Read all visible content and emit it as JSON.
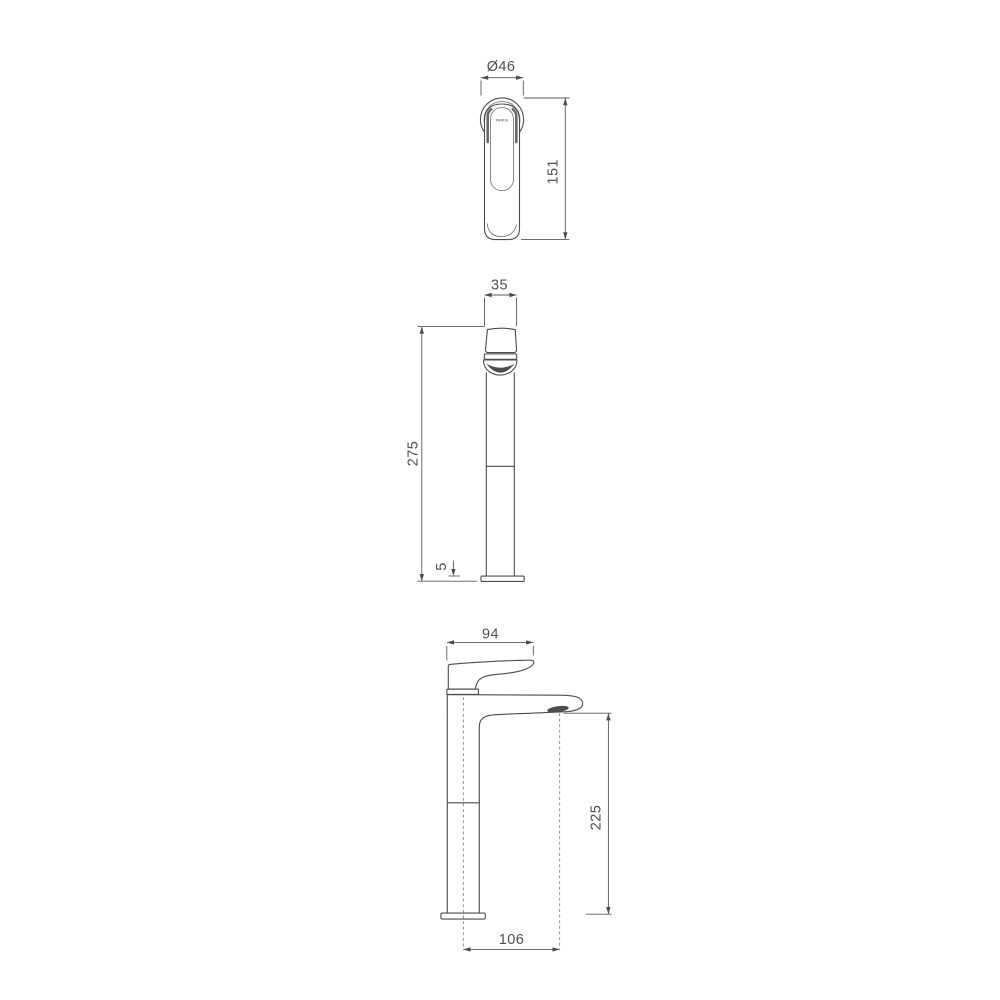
{
  "colors": {
    "background": "#ffffff",
    "outline": "#4c4c4c",
    "dimension_line": "#5a5a5a",
    "label_text": "#4f4f4f",
    "spout_outlet_fill": "#141414"
  },
  "views": {
    "top": {
      "diameter_label": "Ø46",
      "height_label": "151",
      "logo": "PARISI"
    },
    "front": {
      "width_label": "35",
      "height_label": "275",
      "base_label": "5"
    },
    "side": {
      "width_label": "94",
      "height_label": "225",
      "reach_label": "106"
    }
  }
}
